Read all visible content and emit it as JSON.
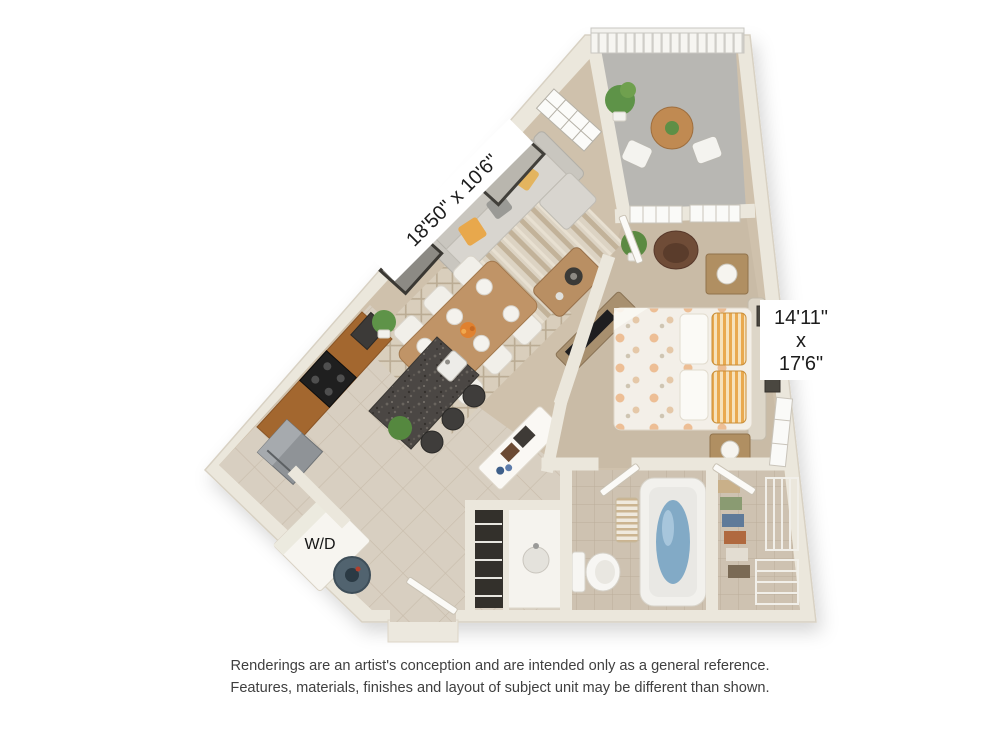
{
  "floor_plan": {
    "labels": {
      "living_dimensions": "18'50\" x 10'6\"",
      "bedroom_dimensions_line1": "14'11\"",
      "bedroom_dimensions_line2": "x",
      "bedroom_dimensions_line3": "17'6\"",
      "washer_dryer": "W/D"
    },
    "colors": {
      "background": "#ffffff",
      "wall": "#ebe7dc",
      "wall_outline": "#d8d1c3",
      "carpet_living": "#cfc1ac",
      "carpet_bedroom": "#c9bba6",
      "tile_floor": "#d8cfc1",
      "bath_tile": "#cec2b1",
      "balcony_floor": "#b8b7b3",
      "cabinet_brown": "#a3672f",
      "island_granite": "#4b4744",
      "accent_pillow_orange": "#e8a84c",
      "tub_water": "#82aac6",
      "vacuum_blue": "#51636f",
      "plant_green": "#5e9348",
      "label_text": "#1c1c1c",
      "disclaimer_text": "#3f3f3f"
    }
  },
  "disclaimer": {
    "line1": "Renderings are an artist's conception and are intended only as a general reference.",
    "line2": "Features, materials, finishes and layout of subject unit may be different than shown."
  }
}
